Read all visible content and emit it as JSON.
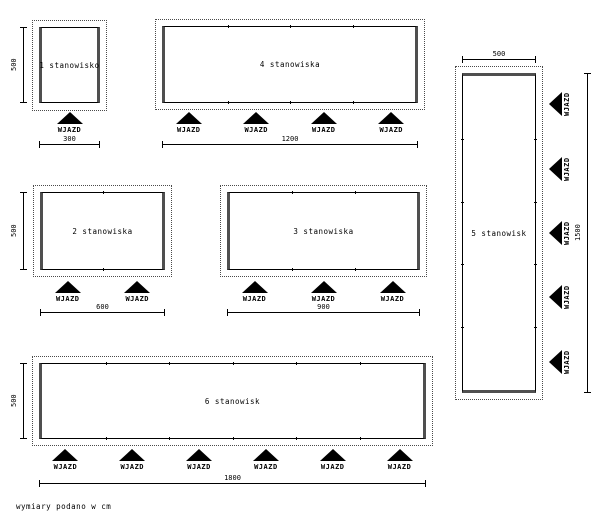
{
  "title": "garage layout variants drawing",
  "units_note": "wymiary podano w cm",
  "entrance_label": "WJAZD",
  "colors": {
    "line": "#000000",
    "wall": "#4f4f4f",
    "background": "#ffffff"
  },
  "layouts": [
    {
      "name": "1 stanowisko",
      "stalls": 1,
      "entrances": 1,
      "width_label": "300",
      "depth_label": "500"
    },
    {
      "name": "2 stanowiska",
      "stalls": 2,
      "entrances": 2,
      "width_label": "600",
      "depth_label": "500"
    },
    {
      "name": "3 stanowiska",
      "stalls": 3,
      "entrances": 3,
      "width_label": "900"
    },
    {
      "name": "4 stanowiska",
      "stalls": 4,
      "entrances": 4,
      "width_label": "1200"
    },
    {
      "name": "5 stanowisk",
      "stalls": 5,
      "entrances": 5,
      "width_label": "500",
      "depth_label": "1500"
    },
    {
      "name": "6 stanowisk",
      "stalls": 6,
      "entrances": 6,
      "width_label": "1800",
      "depth_label": "500"
    }
  ]
}
